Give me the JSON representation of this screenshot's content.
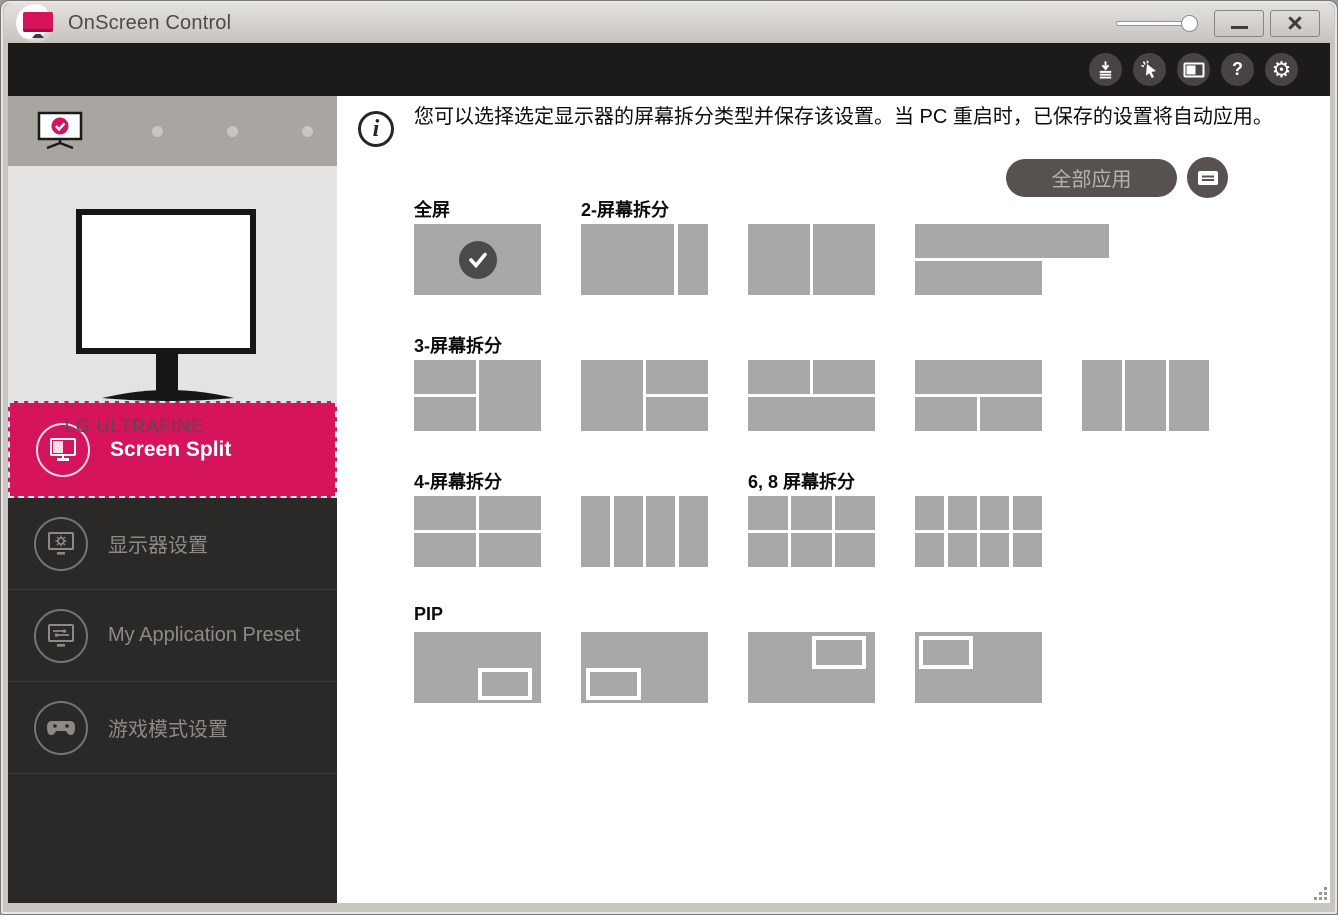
{
  "window": {
    "title": "OnScreen Control",
    "controls": {
      "minimize": "minimize-button",
      "close": "close-button",
      "opacity_slider": "opacity-slider"
    }
  },
  "toolbar": {
    "icons": [
      {
        "name": "download-icon"
      },
      {
        "name": "auto-arrange-cursor-icon"
      },
      {
        "name": "display-mode-icon"
      },
      {
        "name": "help-icon",
        "glyph": "?"
      },
      {
        "name": "settings-gear-icon",
        "glyph": "⚙"
      }
    ]
  },
  "sidebar": {
    "monitor_selector": {
      "active_monitor": 1,
      "inactive_dots": 3
    },
    "monitor_name": "LG ULTRAFINE",
    "nav": [
      {
        "label": "Screen Split",
        "icon": "screen-split-icon",
        "active": true
      },
      {
        "label": "显示器设置",
        "icon": "monitor-settings-icon",
        "active": false
      },
      {
        "label": "My Application Preset",
        "icon": "app-preset-icon",
        "active": false
      },
      {
        "label": "游戏模式设置",
        "icon": "game-mode-icon",
        "active": false
      }
    ]
  },
  "main": {
    "info_text": "您可以选择选定显示器的屏幕拆分类型并保存该设置。当 PC 重启时，已保存的设置将自动应用。",
    "apply_all_label": "全部应用",
    "sections": [
      {
        "id": "full-screen",
        "label": "全屏",
        "thumbs": [
          {
            "name": "full",
            "layout": "full",
            "selected": true
          }
        ]
      },
      {
        "id": "split-2",
        "label": "2-屏幕拆分",
        "thumbs": [
          {
            "name": "2-left-wide",
            "layout": "v70_30"
          },
          {
            "name": "2-equal-columns",
            "layout": "v50_50"
          },
          {
            "name": "2-equal-rows",
            "layout": "h50_50"
          }
        ]
      },
      {
        "id": "split-3",
        "label": "3-屏幕拆分",
        "thumbs": [
          {
            "name": "3-left-stack-right-full",
            "layout": "left2_right1"
          },
          {
            "name": "3-left-full-right-stack",
            "layout": "left1_right2"
          },
          {
            "name": "3-top-pair-bottom-full",
            "layout": "top2_bottom1"
          },
          {
            "name": "3-top-full-bottom-pair",
            "layout": "top1_bottom2"
          },
          {
            "name": "3-columns",
            "layout": "v3"
          }
        ]
      },
      {
        "id": "split-4",
        "label": "4-屏幕拆分",
        "thumbs": [
          {
            "name": "4-grid",
            "layout": "grid2x2"
          },
          {
            "name": "4-columns",
            "layout": "v4"
          }
        ]
      },
      {
        "id": "split-6-8",
        "label": "6, 8 屏幕拆分",
        "thumbs": [
          {
            "name": "6-grid",
            "layout": "grid3x2"
          },
          {
            "name": "8-grid",
            "layout": "grid4x2"
          }
        ]
      },
      {
        "id": "pip",
        "label": "PIP",
        "thumbs": [
          {
            "name": "pip-bottom-right",
            "layout": "pip_br"
          },
          {
            "name": "pip-bottom-left",
            "layout": "pip_bl"
          },
          {
            "name": "pip-top-right",
            "layout": "pip_tr"
          },
          {
            "name": "pip-top-left",
            "layout": "pip_tl"
          }
        ]
      }
    ],
    "layouts": {
      "full": {
        "cells": [
          [
            0,
            0,
            100,
            100
          ]
        ]
      },
      "v70_30": {
        "cells": [
          [
            0,
            0,
            73,
            100
          ],
          [
            76.2,
            0,
            23.8,
            100
          ]
        ]
      },
      "v50_50": {
        "cells": [
          [
            0,
            0,
            48.7,
            100
          ],
          [
            51.3,
            0,
            48.7,
            100
          ]
        ]
      },
      "h50_50": {
        "cells": [
          [
            0,
            0,
            100,
            47.2
          ],
          [
            52.8,
            0,
            100,
            47.2
          ],
          [
            0,
            52.8,
            100,
            47.2
          ]
        ]
      },
      "left2_right1": {
        "cells": [
          [
            0,
            0,
            48.7,
            47.2
          ],
          [
            0,
            52.8,
            48.7,
            47.2
          ],
          [
            51.3,
            0,
            48.7,
            100
          ]
        ]
      },
      "left1_right2": {
        "cells": [
          [
            0,
            0,
            48.7,
            100
          ],
          [
            51.3,
            0,
            48.7,
            47.2
          ],
          [
            51.3,
            52.8,
            48.7,
            47.2
          ]
        ]
      },
      "top2_bottom1": {
        "cells": [
          [
            0,
            0,
            48.7,
            47.2
          ],
          [
            51.3,
            0,
            48.7,
            47.2
          ],
          [
            0,
            52.8,
            100,
            47.2
          ]
        ]
      },
      "top1_bottom2": {
        "cells": [
          [
            0,
            0,
            100,
            47.2
          ],
          [
            0,
            52.8,
            48.7,
            47.2
          ],
          [
            51.3,
            52.8,
            48.7,
            47.2
          ]
        ]
      },
      "v3": {
        "cells": [
          [
            0,
            0,
            31.8,
            100
          ],
          [
            34.2,
            0,
            31.6,
            100
          ],
          [
            68.2,
            0,
            31.8,
            100
          ]
        ]
      },
      "grid2x2": {
        "cells": [
          [
            0,
            0,
            48.7,
            47.2
          ],
          [
            51.3,
            0,
            48.7,
            47.2
          ],
          [
            0,
            52.8,
            48.7,
            47.2
          ],
          [
            51.3,
            52.8,
            48.7,
            47.2
          ]
        ]
      },
      "v4": {
        "cells": [
          [
            0,
            0,
            23.2,
            100
          ],
          [
            25.6,
            0,
            23.2,
            100
          ],
          [
            51.2,
            0,
            23.2,
            100
          ],
          [
            76.8,
            0,
            23.2,
            100
          ]
        ]
      },
      "grid3x2": {
        "cells": [
          [
            0,
            0,
            31.8,
            47.2
          ],
          [
            34.2,
            0,
            31.6,
            47.2
          ],
          [
            68.2,
            0,
            31.8,
            47.2
          ],
          [
            0,
            52.8,
            31.8,
            47.2
          ],
          [
            34.2,
            52.8,
            31.6,
            47.2
          ],
          [
            68.2,
            52.8,
            31.8,
            47.2
          ]
        ]
      },
      "grid4x2": {
        "cells": [
          [
            0,
            0,
            23.2,
            47.2
          ],
          [
            25.6,
            0,
            23.2,
            47.2
          ],
          [
            51.2,
            0,
            23.2,
            47.2
          ],
          [
            76.8,
            0,
            23.2,
            47.2
          ],
          [
            0,
            52.8,
            23.2,
            47.2
          ],
          [
            25.6,
            52.8,
            23.2,
            47.2
          ],
          [
            51.2,
            52.8,
            23.2,
            47.2
          ],
          [
            76.8,
            52.8,
            23.2,
            47.2
          ]
        ]
      },
      "pip_br": {
        "cells": [
          [
            0,
            0,
            100,
            100
          ]
        ],
        "pip": [
          50,
          50,
          43,
          46
        ]
      },
      "pip_bl": {
        "cells": [
          [
            0,
            0,
            100,
            100
          ]
        ],
        "pip": [
          4,
          50,
          43,
          46
        ]
      },
      "pip_tr": {
        "cells": [
          [
            0,
            0,
            100,
            100
          ]
        ],
        "pip": [
          50,
          6,
          43,
          46
        ]
      },
      "pip_tl": {
        "cells": [
          [
            0,
            0,
            100,
            100
          ]
        ],
        "pip": [
          3,
          6,
          43,
          46
        ]
      }
    }
  },
  "colors": {
    "accent_pink": "#d6145c",
    "toolbar_black": "#1d1b1a",
    "sidebar_dark": "#2b2927",
    "thumb_gray": "#a8a8a8",
    "check_circle": "#4a4a4a",
    "apply_button": "#575250",
    "apply_button_text": "#b6b1ac"
  }
}
